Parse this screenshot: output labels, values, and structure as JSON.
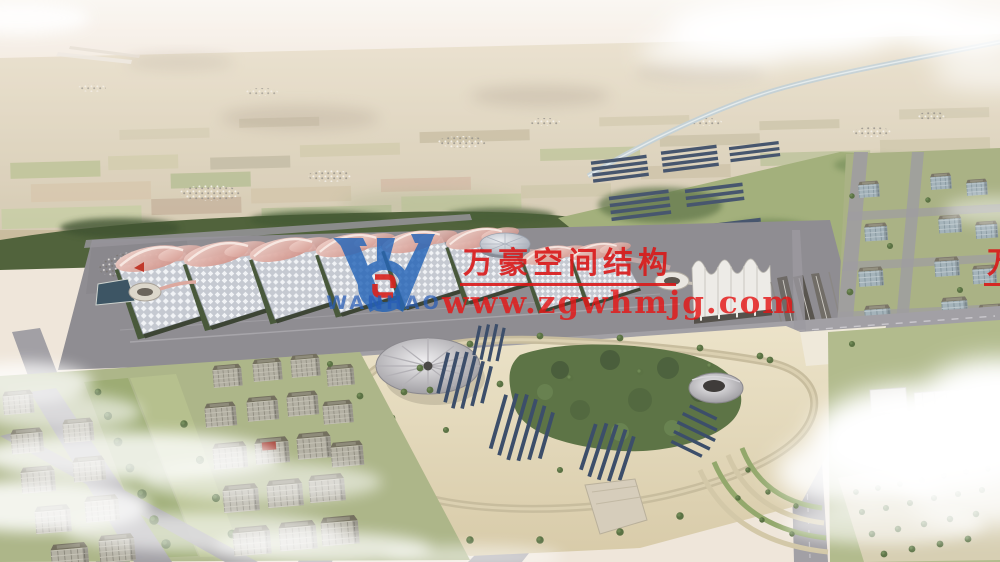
{
  "watermark": {
    "logo_text": "WANHAO",
    "company_name": "万豪空间结构",
    "company_name_right_edge": "万豪空间结构",
    "website": "www.zgwhmjg.com",
    "text_color": "#d91818",
    "logo_blue": "#2565b8",
    "monogram_red": "#d8251f"
  },
  "palette": {
    "sky_haze": "#f5eee6",
    "farmland": "#cfc0a1",
    "greenbelt": "#51633c",
    "expo_roof_grid": "#c9ccd3",
    "membrane_pink": "#dda79d",
    "station_roof": "#edebe7",
    "road": "#a2a0a5",
    "park_sand": "#e4dabf",
    "park_forest": "#5d7446",
    "solar_panel": "#3c4e6a",
    "pond_water": "#3d5564",
    "canal_water": "#b5c4c9",
    "cloud": "#ffffff"
  }
}
